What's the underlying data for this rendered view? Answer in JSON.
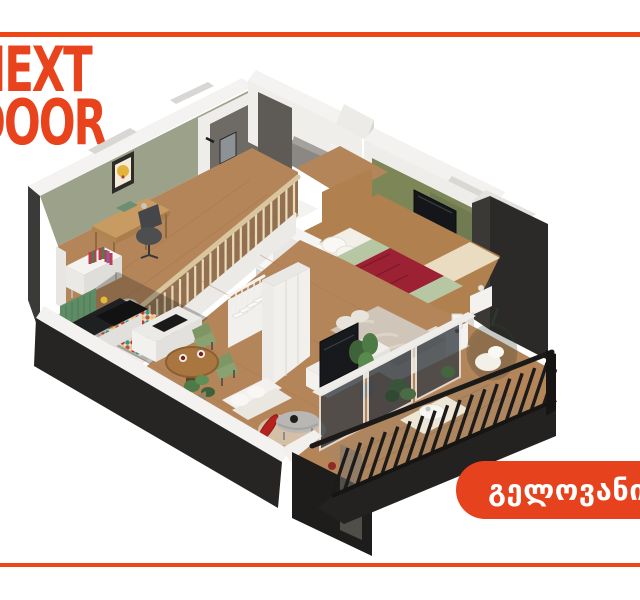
{
  "brand": {
    "logo_line1": "NEXT",
    "logo_line2": "DOOR"
  },
  "location_button": {
    "label": "გელოვანი"
  },
  "decor": {
    "accent_color": "#EE4716",
    "brand_color": "#E8431C",
    "button_color": "#E6421D",
    "button_text_color": "#FFFFFF"
  },
  "floorplan": {
    "type": "3d-isometric-cutaway-apartment",
    "levels": 2,
    "rooms": [
      "study",
      "bathroom",
      "mezzanine-bedroom",
      "living-room",
      "kitchen",
      "dining-area",
      "bedroom",
      "staircase",
      "balcony"
    ]
  }
}
